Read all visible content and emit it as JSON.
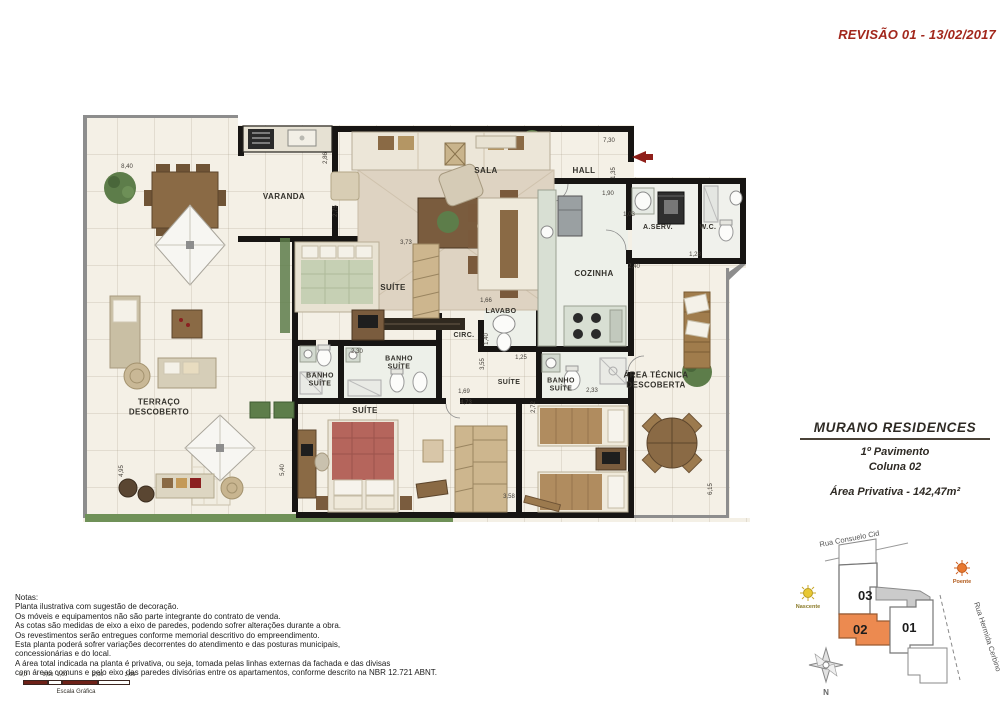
{
  "revision": "REVISÃO 01 - 13/02/2017",
  "title_block": {
    "project": "MURANO RESIDENCES",
    "floor": "1º Pavimento",
    "column": "Coluna 02",
    "area": "Área Privativa - 142,47m²"
  },
  "plan": {
    "rooms": [
      {
        "label": "VARANDA"
      },
      {
        "label": "SALA"
      },
      {
        "label": "HALL"
      },
      {
        "label": "A.SERV."
      },
      {
        "label": "W.C."
      },
      {
        "label": "COZINHA"
      },
      {
        "label": "SUÍTE"
      },
      {
        "label": "LAVABO"
      },
      {
        "label": "CIRC."
      },
      {
        "label": "BANHO\nSUÍTE"
      },
      {
        "label": "BANHO\nSUÍTE"
      },
      {
        "label": "SUÍTE"
      },
      {
        "label": "BANHO\nSUÍTE"
      },
      {
        "label": "SUÍTE"
      },
      {
        "label": "TERRAÇO\nDESCOBERTO"
      },
      {
        "label": "ÁREA TÉCNICA\nDESCOBERTA"
      }
    ],
    "dimensions": [
      {
        "v": "8,40"
      },
      {
        "v": "2,86"
      },
      {
        "v": "3,73"
      },
      {
        "v": "7,30"
      },
      {
        "v": "1,35"
      },
      {
        "v": "1,90"
      },
      {
        "v": "1,03"
      },
      {
        "v": "1,28"
      },
      {
        "v": "2,40"
      },
      {
        "v": "1,66"
      },
      {
        "v": "1,40"
      },
      {
        "v": "2,30"
      },
      {
        "v": "1,25"
      },
      {
        "v": "3,55"
      },
      {
        "v": "1,69"
      },
      {
        "v": "4,73"
      },
      {
        "v": "2,33"
      },
      {
        "v": "2,72"
      },
      {
        "v": "3,58"
      },
      {
        "v": "6,15"
      },
      {
        "v": "4,95"
      },
      {
        "v": "5,40"
      },
      {
        "v": "2,75"
      }
    ]
  },
  "notes": {
    "heading": "Notas:",
    "lines": [
      "Planta ilustrativa com sugestão de decoração.",
      "Os móveis e equipamentos não são parte integrante do contrato de venda.",
      "As cotas são medidas de eixo a eixo de paredes, podendo sofrer alterações durante a obra.",
      "Os revestimentos serão entregues conforme memorial descritivo do empreendimento.",
      "Esta planta poderá sofrer variações decorrentes do atendimento e das posturas municipais,",
      "concessionárias e do local.",
      "A área total indicada na planta é privativa, ou seja, tomada pelas linhas externas da fachada e das divisas",
      "com áreas comuns e pelo eixo das paredes divisórias entre os apartamentos, conforme descrito na NBR 12.721 ABNT."
    ]
  },
  "scale_bar": {
    "ticks": [
      "0,0",
      "0,50",
      "1,00",
      "2,00",
      "3,00"
    ],
    "caption": "Escala Gráfica"
  },
  "site_map": {
    "street_top": "Rua Consuelo Cid",
    "street_right": "Rua Hermida Cerbino",
    "units": [
      {
        "number": "03"
      },
      {
        "number": "02"
      },
      {
        "number": "01"
      }
    ],
    "highlighted_unit": "02",
    "sun_east_label": "Nascente",
    "sun_west_label": "Poente",
    "compass_label": "N",
    "highlight_color": "#ec8a50"
  },
  "colors": {
    "revision_red": "#a2271c",
    "wall_black": "#171513",
    "floor_cream": "#f4f0e6",
    "accent_orange": "#ec8a50"
  }
}
